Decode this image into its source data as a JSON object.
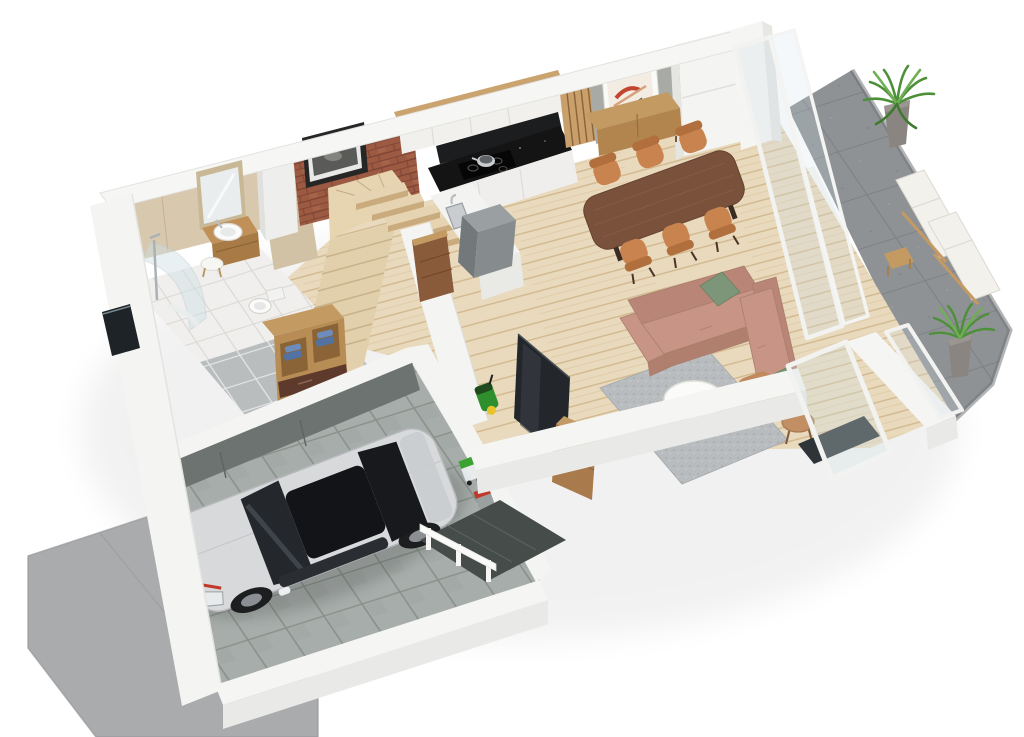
{
  "scene": {
    "title": "3D isometric floor-plan render — ground floor",
    "style": "architectural visualization, cutaway walls, white background",
    "rooms": [
      {
        "name": "garage",
        "floor": "grey ceramic tile",
        "contents": [
          "silver hatchback car",
          "green pressure washer",
          "garden equipment cart"
        ]
      },
      {
        "name": "driveway",
        "floor": "grey concrete pad",
        "contents": []
      },
      {
        "name": "entry-hall",
        "floor": "grey tile",
        "contents": [
          "open oak wardrobe with blue towels",
          "drawer chest"
        ]
      },
      {
        "name": "bathroom",
        "floor": "white tile",
        "contents": [
          "corner glass shower",
          "wood vanity with vessel sink",
          "mirror",
          "toilet",
          "round stool",
          "west facade window slit"
        ]
      },
      {
        "name": "staircase",
        "contents": [
          "lower oak flight",
          "winder landing",
          "floating cantilever treads over kitchen island"
        ]
      },
      {
        "name": "kitchen",
        "contents": [
          "white upper cabinets with oak cap",
          "black stone countertop",
          "induction hob with pot",
          "white base cabinets",
          "island with steel sink",
          "grey extractor cube",
          "rust side panel"
        ]
      },
      {
        "name": "dining-area",
        "contents": [
          "walnut dining table",
          "six tan barrel chairs",
          "oak sideboard",
          "framed abstract art on concrete wall",
          "wood slat panels",
          "tall white cabinet"
        ]
      },
      {
        "name": "living-room",
        "contents": [
          "rose L-shaped sectional sofa",
          "two sage pillows",
          "grey shag rug",
          "white round coffee table",
          "tan armchair",
          "tan round side table",
          "TV leaning on garage wall",
          "wood media console",
          "open glass door"
        ]
      },
      {
        "name": "terrace",
        "floor": "grey stone slabs",
        "contents": [
          "two white sun loungers",
          "wood stool",
          "potted plant north",
          "potted plant south",
          "glass sliding doors",
          "white partition wall",
          "glass balustrade"
        ]
      },
      {
        "name": "feature-walls",
        "contents": [
          "red brick chimney wall with framed photo",
          "white chimney column"
        ]
      }
    ]
  },
  "colors": {
    "background": "#ffffff",
    "wallTop": "#f6f6f4",
    "wallSide": "#e9e9e7",
    "woodFloor": "#e9d9bd",
    "hallTile": "#b9bdbe",
    "bathFloor": "#f0efed",
    "garageTile": "#a7adaa",
    "garageWallDark": "#6d7371",
    "terrace": "#8f9295",
    "driveway": "#a9abad",
    "walkway": "#454c49",
    "brick": "#9d5a42",
    "concrete": "#a8aaa5",
    "slats": "#c9a06b",
    "cabinetWhite": "#f1f0ed",
    "counterBlack": "#141414",
    "woodCabinet": "#c49a63",
    "woodCabinetDark": "#b2854f",
    "rustPanel": "#8a5b3a",
    "stairWood": "#e4d1ae",
    "tableWood": "#7a523c",
    "chairTan": "#c9834f",
    "sofa": "#c79485",
    "sofaBack": "#b98576",
    "pillow": "#7d967a",
    "rug": "#b9bcbe",
    "coffeeTable": "#fbfbfa",
    "sideTable": "#c18f63",
    "tv": "#23272b",
    "mediaWood": "#a87a4c",
    "carSilver": "#d7d9db",
    "carGlass": "#121417",
    "carAccent": "#c0392b",
    "plant": "#4e8f3a",
    "pot": "#8b8582",
    "equipGreen": "#2f8f2c",
    "equipYellow": "#e8c22a",
    "equipRed": "#c0392b",
    "loungerWhite": "#f3f1ec",
    "loungerWood": "#c49a62",
    "glassTint": "#cfe0e6",
    "beigeWall": "#d7c8ae",
    "mirror": "#e9edee",
    "chrome": "#b8bec2",
    "windowDark": "#1d2327",
    "threshold": "#2e3437"
  }
}
